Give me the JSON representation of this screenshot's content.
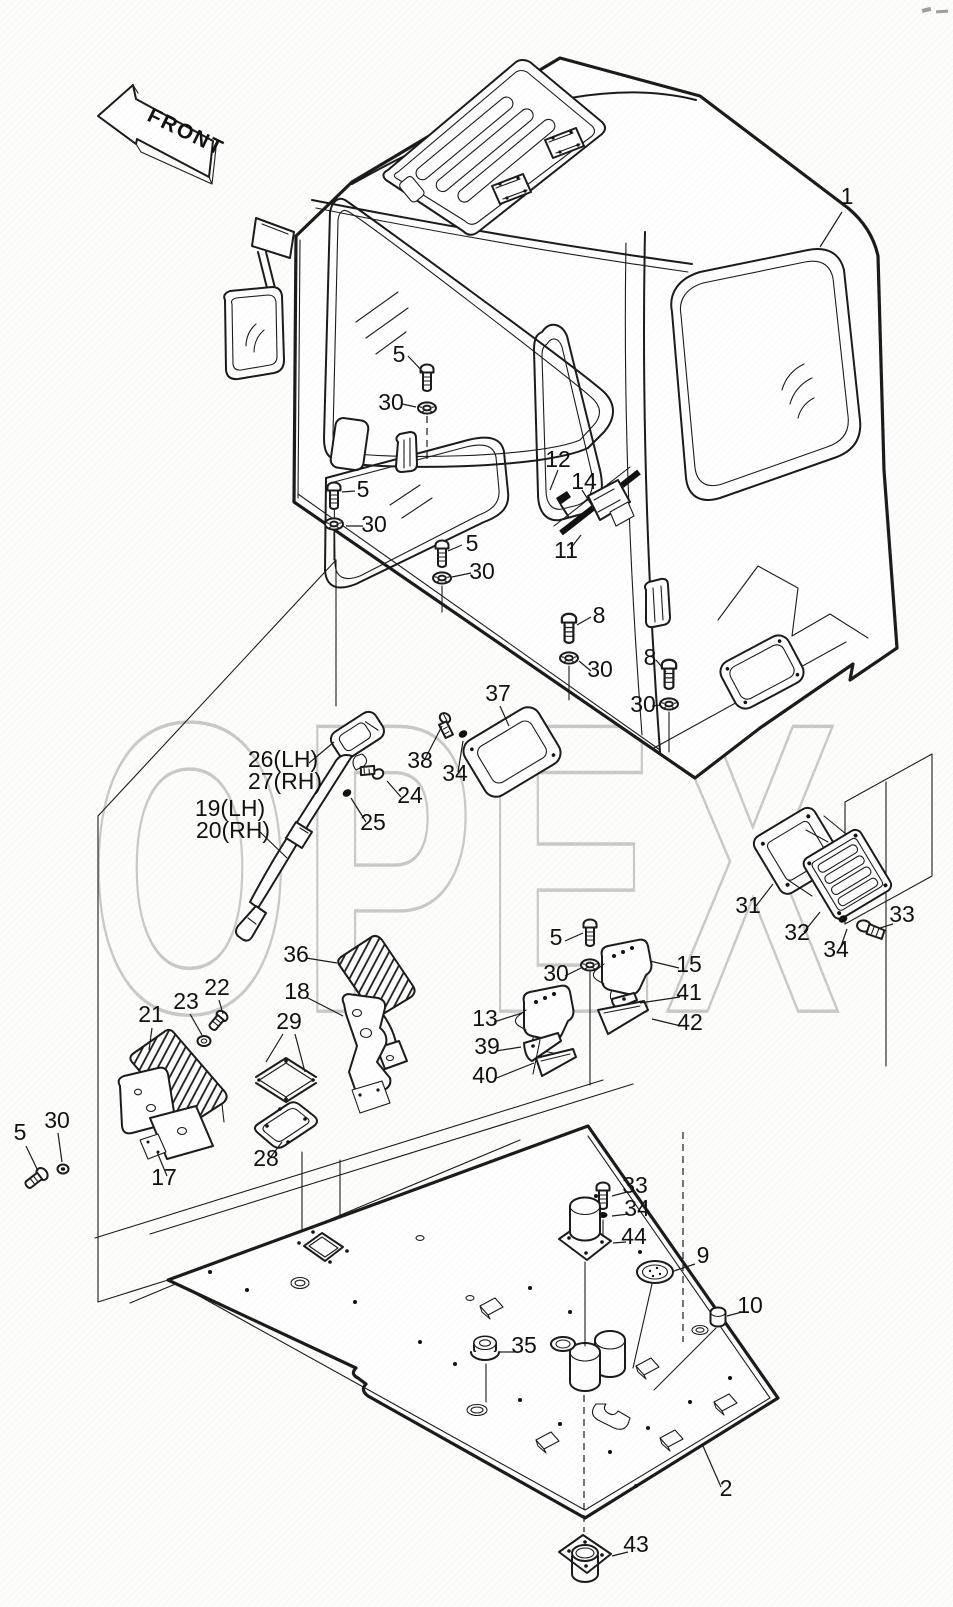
{
  "front_arrow": {
    "label": "FRONT"
  },
  "watermark": {
    "text": "OPEX",
    "color": "#c7c7c7"
  },
  "colors": {
    "line": "#1b1b1b",
    "paper": "#fdfdfc",
    "watermark": "#c7c7c7"
  },
  "part_labels": [
    {
      "text": "1",
      "x": 847,
      "y": 204
    },
    {
      "text": "5",
      "x": 399,
      "y": 362
    },
    {
      "text": "30",
      "x": 391,
      "y": 410
    },
    {
      "text": "5",
      "x": 363,
      "y": 497
    },
    {
      "text": "30",
      "x": 374,
      "y": 532
    },
    {
      "text": "5",
      "x": 472,
      "y": 551
    },
    {
      "text": "30",
      "x": 482,
      "y": 579
    },
    {
      "text": "12",
      "x": 558,
      "y": 467
    },
    {
      "text": "14",
      "x": 584,
      "y": 489
    },
    {
      "text": "11",
      "x": 566,
      "y": 558
    },
    {
      "text": "8",
      "x": 599,
      "y": 623
    },
    {
      "text": "30",
      "x": 600,
      "y": 677
    },
    {
      "text": "8",
      "x": 650,
      "y": 665
    },
    {
      "text": "30",
      "x": 643,
      "y": 712
    },
    {
      "text": "37",
      "x": 498,
      "y": 701
    },
    {
      "text": "38",
      "x": 420,
      "y": 768
    },
    {
      "text": "34",
      "x": 455,
      "y": 781
    },
    {
      "text": "26(LH)",
      "x": 283,
      "y": 767
    },
    {
      "text": "27(RH)",
      "x": 285,
      "y": 789
    },
    {
      "text": "24",
      "x": 410,
      "y": 803
    },
    {
      "text": "25",
      "x": 373,
      "y": 830
    },
    {
      "text": "19(LH)",
      "x": 230,
      "y": 816
    },
    {
      "text": "20(RH)",
      "x": 233,
      "y": 838
    },
    {
      "text": "31",
      "x": 748,
      "y": 913
    },
    {
      "text": "32",
      "x": 797,
      "y": 940
    },
    {
      "text": "34",
      "x": 836,
      "y": 957
    },
    {
      "text": "33",
      "x": 902,
      "y": 922
    },
    {
      "text": "5",
      "x": 556,
      "y": 945
    },
    {
      "text": "30",
      "x": 556,
      "y": 981
    },
    {
      "text": "15",
      "x": 689,
      "y": 972
    },
    {
      "text": "41",
      "x": 689,
      "y": 1000
    },
    {
      "text": "42",
      "x": 690,
      "y": 1030
    },
    {
      "text": "13",
      "x": 485,
      "y": 1026
    },
    {
      "text": "39",
      "x": 487,
      "y": 1054
    },
    {
      "text": "40",
      "x": 485,
      "y": 1083
    },
    {
      "text": "36",
      "x": 296,
      "y": 962
    },
    {
      "text": "18",
      "x": 297,
      "y": 999
    },
    {
      "text": "22",
      "x": 217,
      "y": 995
    },
    {
      "text": "23",
      "x": 186,
      "y": 1009
    },
    {
      "text": "21",
      "x": 151,
      "y": 1022
    },
    {
      "text": "29",
      "x": 289,
      "y": 1029
    },
    {
      "text": "28",
      "x": 266,
      "y": 1166
    },
    {
      "text": "17",
      "x": 164,
      "y": 1185
    },
    {
      "text": "5",
      "x": 20,
      "y": 1140
    },
    {
      "text": "30",
      "x": 57,
      "y": 1128
    },
    {
      "text": "33",
      "x": 635,
      "y": 1193
    },
    {
      "text": "34",
      "x": 637,
      "y": 1216
    },
    {
      "text": "44",
      "x": 634,
      "y": 1244
    },
    {
      "text": "9",
      "x": 703,
      "y": 1263
    },
    {
      "text": "10",
      "x": 750,
      "y": 1313
    },
    {
      "text": "35",
      "x": 524,
      "y": 1353
    },
    {
      "text": "2",
      "x": 726,
      "y": 1496
    },
    {
      "text": "43",
      "x": 636,
      "y": 1552
    }
  ]
}
